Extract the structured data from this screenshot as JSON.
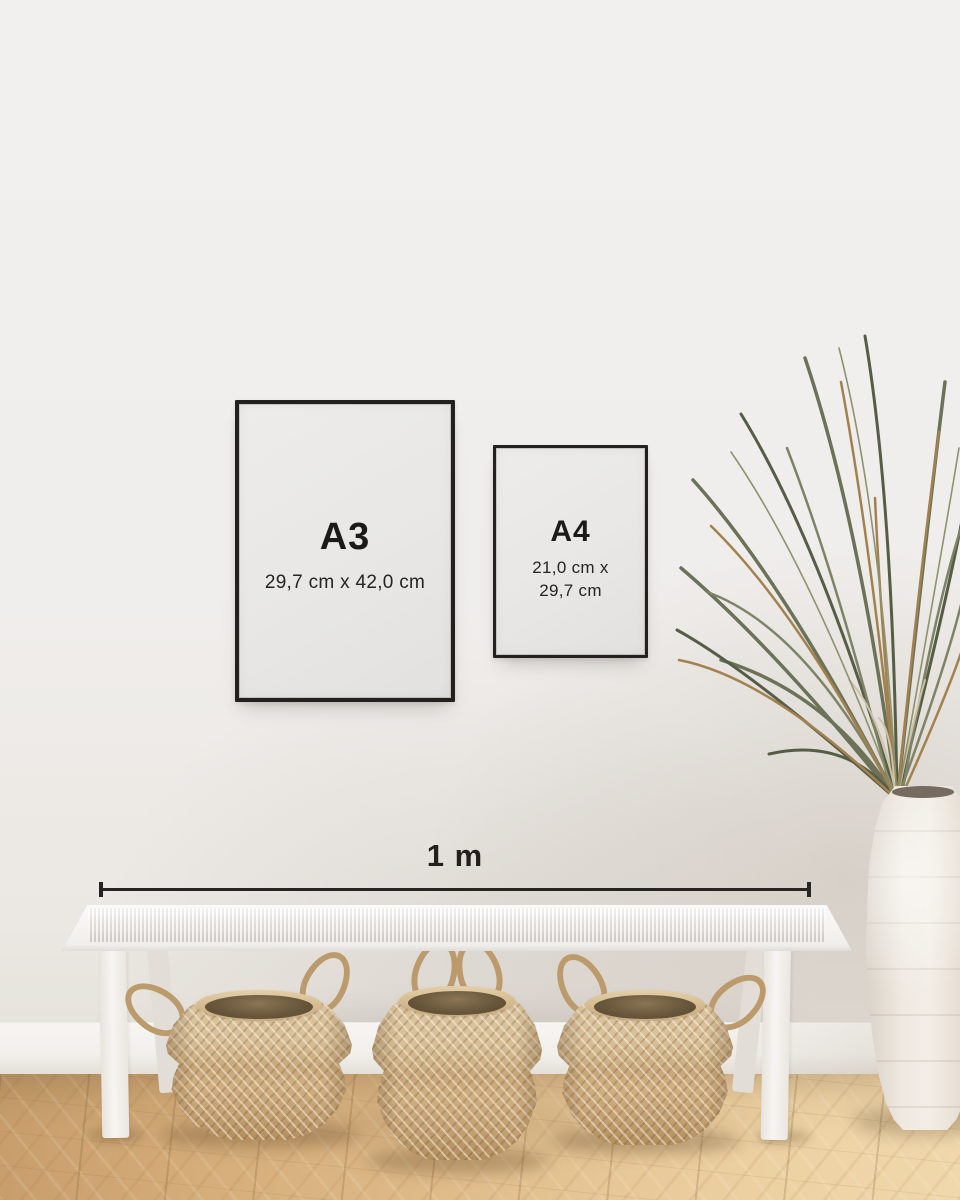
{
  "frames": {
    "a3": {
      "label": "A3",
      "dimensions": "29,7 cm x 42,0 cm"
    },
    "a4": {
      "label": "A4",
      "dimensions_line1": "21,0 cm x",
      "dimensions_line2": "29,7 cm"
    }
  },
  "ruler": {
    "label": "1 m"
  },
  "palette": {
    "wall": "#f0eeec",
    "frame_border": "#23211f",
    "frame_paper": "#e8e7e5",
    "text": "#1b1a19",
    "ruler_line": "#262523",
    "floor_wood": "#dcb585",
    "baseboard": "#f2efeb",
    "bench_white": "#f7f5f2",
    "basket_weave": "#cdab7d",
    "basket_opening": "#6a583d",
    "plant_green": "#6b7257",
    "plant_dried_brown": "#a3814f",
    "vase_ceramic": "#ece6dd"
  }
}
